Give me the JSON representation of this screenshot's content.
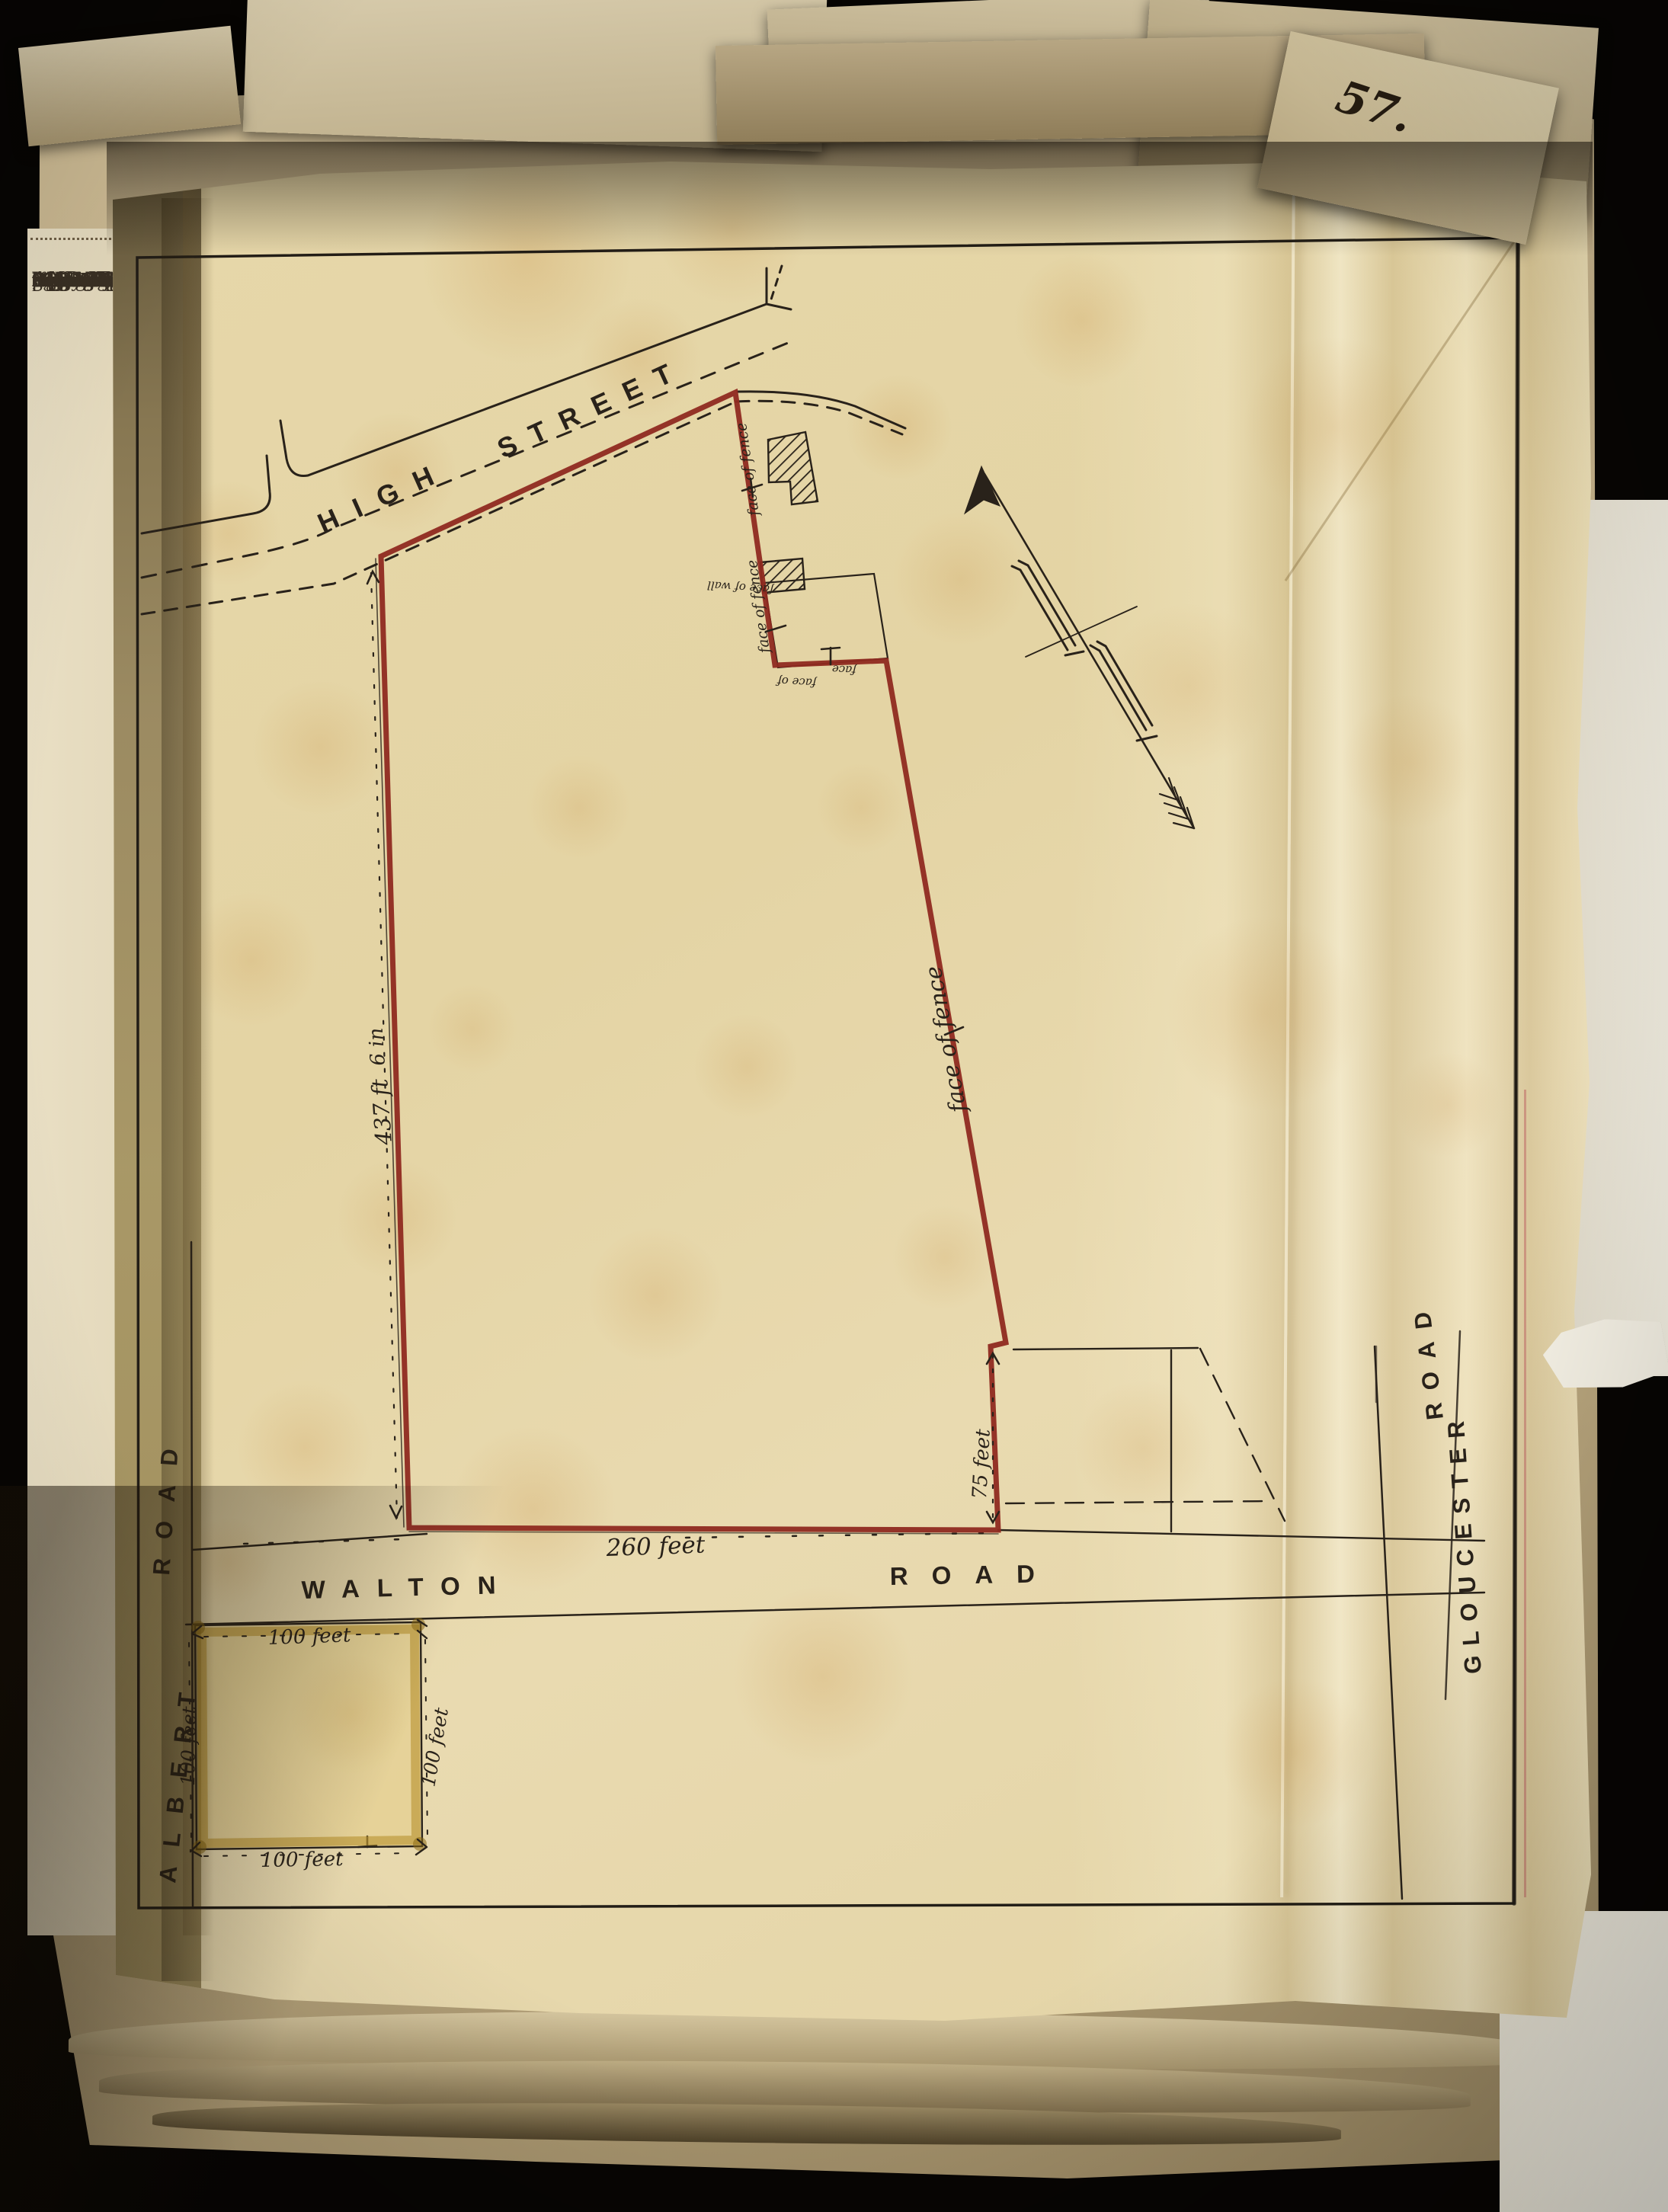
{
  "page_number": "57.",
  "printed_page": {
    "lines": [
      "urpose may",
      "eriving title",
      "nt aforesaid",
      "m from the",
      "D that the",
      "long as the",
      "right of the",
      "AND IT IS",
      "eing to lease",
      "ng and Law",
      "gagor or any",
      "this security",
      "e persons or",
      "ned in every",
      "t in any such",
      "presents have",
      "ve written.",
      "",
      "O.",
      "",
      "Bognor in the",
      "a corner piece",
      "and a frontage",
      "ed 7007 on the",
      "ffice of Land",
      "arly delineated",
      "together with",
      "ther with the",
      "or on the sai",
      "Secondly ALL",
      "and with the",
      "the said pla",
      "nd being th",
      "he Register o",
      "gistry Togethe",
      "hereditament",
      "George Thom",
      "ain Deed date",
      "Land Registry",
      "",
      "M TATE (L.S.)",
      "",
      "",
      "",
      "",
      "",
      "948.",
      "n the Declarati",
      "893,",
      "",
      "BLAKER,",
      "Commissione"
    ]
  },
  "plan": {
    "streets": {
      "high": "HIGH",
      "street": "STREET",
      "walton": "WALTON",
      "walton_road": "ROAD",
      "albert": "ALBERT",
      "albert_road": "ROAD",
      "gloucester": "GLOUCESTER",
      "gloucester_road": "ROAD"
    },
    "annotations": {
      "face_of_fence": "face of fence",
      "face_of_wall": "face of wall",
      "face_of": "face of",
      "face": "face"
    },
    "dimensions": {
      "west_length": "437 ft",
      "west_inches": "6 in",
      "south_length": "260 feet",
      "east_return": "75 feet",
      "square_side": "100 feet"
    },
    "colors": {
      "plot_outline": "#8f2a20",
      "ink": "#29221a",
      "square_wash": "#c9a227"
    }
  }
}
